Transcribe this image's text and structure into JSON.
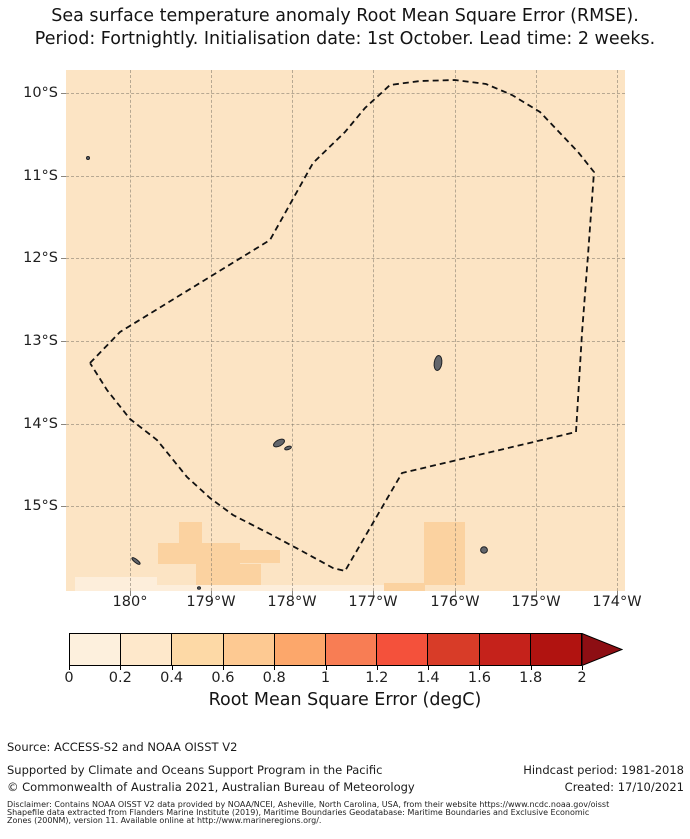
{
  "title": {
    "line1": "Sea surface temperature anomaly Root Mean Square Error (RMSE).",
    "line2": "Period: Fortnightly. Initialisation date: 1st October. Lead time: 2 weeks."
  },
  "map": {
    "ocean_color": "#fce4c4",
    "x_tick_labels": [
      "180°",
      "179°W",
      "178°W",
      "177°W",
      "176°W",
      "175°W",
      "174°W"
    ],
    "y_tick_labels": [
      "10°S",
      "11°S",
      "12°S",
      "13°S",
      "14°S",
      "15°S"
    ],
    "eez_boundary_px": [
      [
        90,
        363
      ],
      [
        120,
        332
      ],
      [
        270,
        240
      ],
      [
        313,
        163
      ],
      [
        345,
        132
      ],
      [
        365,
        108
      ],
      [
        390,
        85
      ],
      [
        420,
        81
      ],
      [
        455,
        80
      ],
      [
        486,
        84
      ],
      [
        512,
        95
      ],
      [
        540,
        112
      ],
      [
        578,
        152
      ],
      [
        594,
        172
      ],
      [
        588,
        255
      ],
      [
        582,
        333
      ],
      [
        576,
        432
      ],
      [
        402,
        473
      ],
      [
        345,
        571
      ],
      [
        333,
        568
      ],
      [
        300,
        550
      ],
      [
        270,
        534
      ],
      [
        233,
        515
      ],
      [
        210,
        498
      ],
      [
        187,
        477
      ],
      [
        157,
        440
      ],
      [
        130,
        419
      ],
      [
        107,
        390
      ],
      [
        90,
        363
      ]
    ],
    "island_fill": "#63666c",
    "island_stroke": "#1f2124",
    "islands": [
      {
        "name": "island-dot-northwest",
        "cx": 88,
        "cy": 158,
        "rx": 1.5,
        "ry": 1.5,
        "rot": 0
      },
      {
        "name": "island-futuna",
        "cx": 279,
        "cy": 443,
        "rx": 6,
        "ry": 3,
        "rot": -28
      },
      {
        "name": "island-alofi",
        "cx": 288,
        "cy": 448,
        "rx": 3.5,
        "ry": 1.6,
        "rot": -18
      },
      {
        "name": "island-wallis",
        "cx": 438,
        "cy": 363,
        "rx": 3.8,
        "ry": 7.5,
        "rot": 8
      },
      {
        "name": "island-round-southeast",
        "cx": 484,
        "cy": 550,
        "rx": 3.4,
        "ry": 3.2,
        "rot": 0
      },
      {
        "name": "island-sliver-southwest",
        "cx": 136,
        "cy": 561,
        "rx": 5,
        "ry": 1.6,
        "rot": 38
      },
      {
        "name": "island-dot-south",
        "cx": 199,
        "cy": 588,
        "rx": 1.5,
        "ry": 1.3,
        "rot": 0
      }
    ],
    "cells": [
      {
        "x": 179,
        "y": 522,
        "w": 23,
        "h": 21,
        "color": "#fbd2a0",
        "bin": "0.4-0.6"
      },
      {
        "x": 158,
        "y": 543,
        "w": 82,
        "h": 21,
        "color": "#fbd2a0",
        "bin": "0.4-0.6"
      },
      {
        "x": 196,
        "y": 564,
        "w": 65,
        "h": 21,
        "color": "#fbd2a0",
        "bin": "0.4-0.6"
      },
      {
        "x": 240,
        "y": 550,
        "w": 40,
        "h": 13,
        "color": "#fbd2a0",
        "bin": "0.4-0.6"
      },
      {
        "x": 424,
        "y": 522,
        "w": 41,
        "h": 63,
        "color": "#fbd2a0",
        "bin": "0.4-0.6"
      },
      {
        "x": 384,
        "y": 583,
        "w": 41,
        "h": 8,
        "color": "#fbd2a0",
        "bin": "0.4-0.6"
      },
      {
        "x": 75,
        "y": 577,
        "w": 82,
        "h": 14,
        "color": "#fdeedb",
        "bin": "0-0.2"
      },
      {
        "x": 157,
        "y": 585,
        "w": 227,
        "h": 6,
        "color": "#fdeedb",
        "bin": "0-0.2"
      }
    ]
  },
  "colorbar": {
    "tick_labels": [
      "0",
      "0.2",
      "0.4",
      "0.6",
      "0.8",
      "1",
      "1.2",
      "1.4",
      "1.6",
      "1.8",
      "2"
    ],
    "colors": [
      "#fdf0dd",
      "#fee8cb",
      "#fdd9a6",
      "#fdc992",
      "#fca76b",
      "#f87d54",
      "#f4513b",
      "#d83c28",
      "#c5221b",
      "#b11310"
    ],
    "arrow_color": "#8d0e13",
    "label": "Root Mean Square Error (degC)"
  },
  "footer": {
    "source": "Source: ACCESS-S2 and NOAA OISST V2",
    "supported": "Supported by Climate and Oceans Support Program in the Pacific",
    "copyright": "© Commonwealth of Australia 2021, Australian Bureau of Meteorology",
    "hindcast": "Hindcast period: 1981-2018",
    "created": "Created: 17/10/2021",
    "disclaimer_line1": "Disclaimer: Contains NOAA OISST V2 data provided by NOAA/NCEI, Asheville, North Carolina, USA, from their website https://www.ncdc.noaa.gov/oisst",
    "disclaimer_line2": "Shapefile data extracted from Flanders Marine Institute (2019), Maritime Boundaries Geodatabase: Maritime Boundaries and Exclusive Economic",
    "disclaimer_line3": "Zones (200NM), version 11. Available online at http://www.marineregions.org/."
  },
  "chart_data": {
    "type": "heatmap",
    "title": "Sea surface temperature anomaly Root Mean Square Error (RMSE). Period: Fortnightly. Initialisation date: 1st October. Lead time: 2 weeks.",
    "x_tick_labels": [
      "180°",
      "179°W",
      "178°W",
      "177°W",
      "176°W",
      "175°W",
      "174°W"
    ],
    "y_tick_labels": [
      "10°S",
      "11°S",
      "12°S",
      "13°S",
      "14°S",
      "15°S"
    ],
    "x_range": [
      "180.8°E",
      "173.9°W"
    ],
    "y_range": [
      "9.7°S",
      "16.0°S"
    ],
    "grid": true,
    "legend_position": "bottom horizontal colorbar",
    "colorbar": {
      "label": "Root Mean Square Error (degC)",
      "ticks": [
        0,
        0.2,
        0.4,
        0.6,
        0.8,
        1,
        1.2,
        1.4,
        1.6,
        1.8,
        2
      ],
      "units": "degC",
      "extend": "max",
      "n_bins": 10
    },
    "field_summary": "RMSE is approximately 0.2-0.4 degC over nearly the whole domain; isolated cells of 0.4-0.6 degC near 179°W-178.5°W and 176.3°W south of 15.2°S; cells of 0-0.2 degC along parts of the southern edge near 15.8°S",
    "overlays": [
      "dashed EEZ boundary polygon",
      "small island landmasses (Wallis, Futuna/Alofi and islets)"
    ]
  }
}
